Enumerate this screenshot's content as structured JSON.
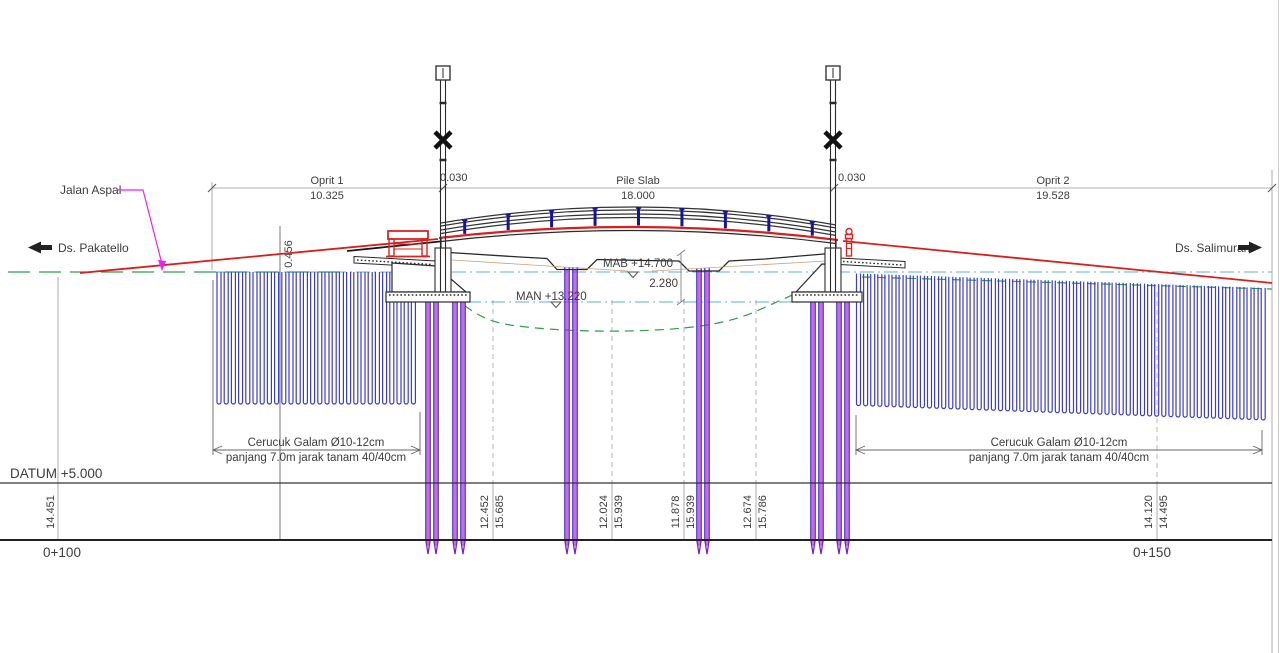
{
  "road": {
    "surface_label": "Jalan Aspal",
    "direction_left": "Ds. Pakatello",
    "direction_right": "Ds. Salimuran"
  },
  "dims": {
    "oprit1_name": "Oprit 1",
    "oprit1_value": "10.325",
    "gap_left": "0.030",
    "pile_slab_name": "Pile Slab",
    "pile_slab_value": "18.000",
    "gap_right": "0.030",
    "oprit2_name": "Oprit 2",
    "oprit2_value": "19.528",
    "embankment_height": "0.456",
    "clearance": "2.280"
  },
  "levels": {
    "mab": "MAB +14.700",
    "man": "MAN +13.220",
    "datum": "DATUM +5.000"
  },
  "cerucuk": {
    "left_line1": "Cerucuk Galam Ø10-12cm",
    "left_line2": "panjang 7.0m jarak tanam 40/40cm",
    "right_line1": "Cerucuk Galam Ø10-12cm",
    "right_line2": "panjang 7.0m jarak tanam 40/40cm"
  },
  "stations": {
    "left": "0+100",
    "right": "0+150"
  },
  "elevations": {
    "col0": {
      "a": "14.451"
    },
    "col1": {
      "a": "12.452",
      "b": "15.685"
    },
    "col2": {
      "a": "12.024",
      "b": "15.939"
    },
    "col3": {
      "a": "11.878",
      "b": "15.939"
    },
    "col4": {
      "a": "12.674",
      "b": "15.786"
    },
    "col5": {
      "a": "14.120",
      "b": "14.495"
    }
  },
  "colors": {
    "road_red": "#d91e1e",
    "rail_red": "#e02222",
    "line_black": "#2a2a2a",
    "pile_blue": "#3b3bcf",
    "pile_magenta": "#cc22cc",
    "pile_tip_violet": "#7a1fd6",
    "water_cyan": "#5ab0cf",
    "ground_green": "#2e9e50",
    "leader_magenta": "#ee22ee",
    "post_navy": "#15159a"
  }
}
